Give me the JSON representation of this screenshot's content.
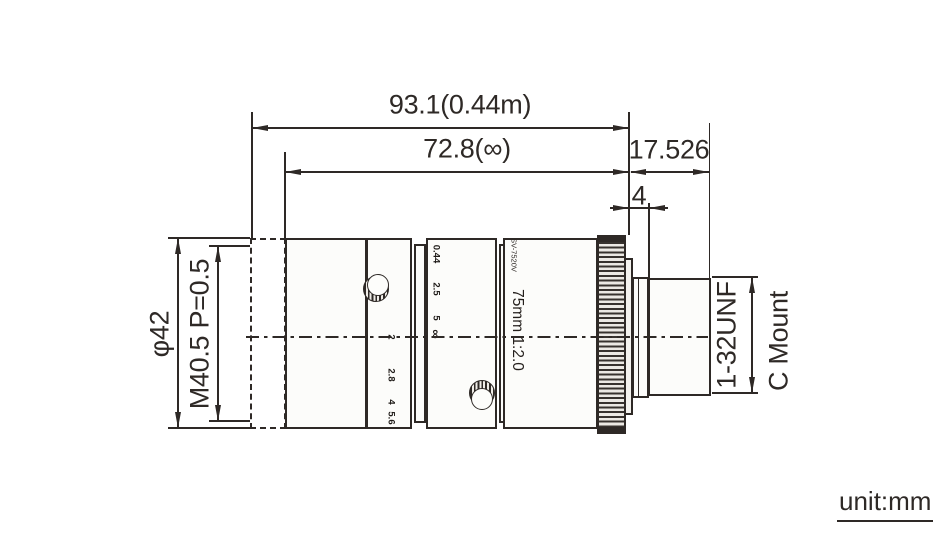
{
  "diagram_title": "C-mount lens dimensional drawing",
  "colors": {
    "ink": "#2e2926",
    "body_fill": "#fcfcfa"
  },
  "dims": {
    "total": "93.1(0.44m)",
    "infinity": "72.8(∞)",
    "flange": "17.526",
    "step": "4",
    "diameter": "φ42",
    "filter": "M40.5 P=0.5",
    "thread": "1-32UNF",
    "mount": "C Mount"
  },
  "lens": {
    "model": "SV-7520V",
    "spec": "75mm 1:2.0",
    "aperture_marks": [
      "2",
      "2.8",
      "4",
      "5.6",
      "8"
    ],
    "focus_marks": [
      "0.44",
      "2.5",
      "5",
      "∞"
    ]
  },
  "footer": {
    "unit": "unit:mm"
  }
}
